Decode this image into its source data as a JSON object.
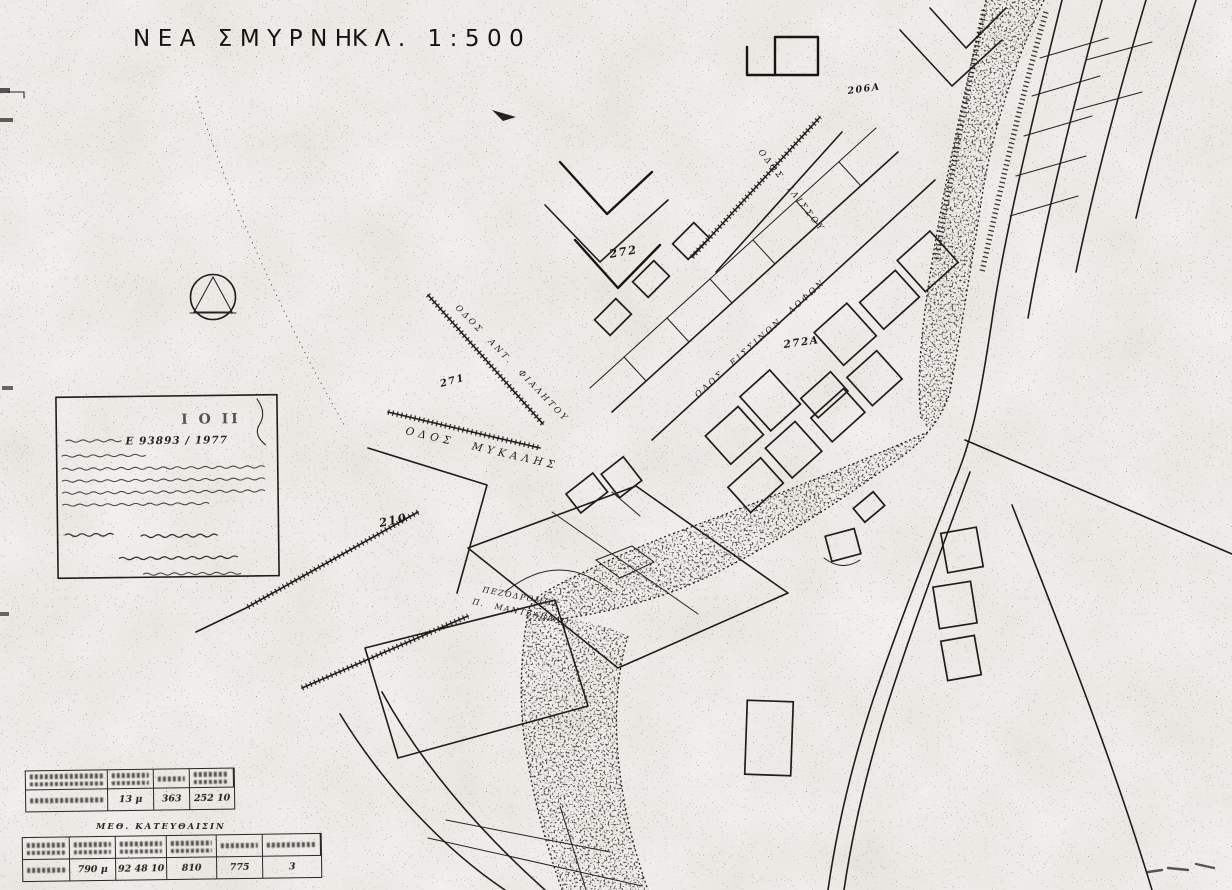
{
  "meta": {
    "paper_color": "#f3f2ee",
    "ink_color": "#1e1d1a"
  },
  "title": {
    "name": "ΝΕΑ ΣΜΥΡΝΗ",
    "scale": "ΚΛ. 1:500"
  },
  "streets": {
    "mykalis": "ΟΔΟΣ ΜΥΚΑΛΗΣ",
    "fialitou": "ΟΔΟΣ ΑΝΤ. ΦΙΑΛΗΤΟΥ",
    "lofon": "ΟΔΟΣ ΕΙΣΣΙΝΩΝ ΛΟΦΩΝ",
    "ilissou": "ΟΔΟΣ ΙΛΙΣΣΟΥ",
    "pezodromos_line1": "ΠΕΖΟΔΡΟΜΟΣ",
    "pezodromos_line2": "Π. ΜΑΝΤΖΑΒΑΛΟ"
  },
  "blocks": {
    "b206a": "206Α",
    "b272": "272",
    "b272a": "272Α",
    "b271": "271",
    "b210": "210"
  },
  "stamp": {
    "header_fragment": "Ι Ο ΙΙ",
    "protocol_number": "Ε 93893 / 1977"
  },
  "tables": {
    "measurements": {
      "row": [
        "13 μ",
        "363",
        "252 10"
      ]
    },
    "directions": {
      "title": "ΜΕΘ. ΚΑΤΕΥΘΑΙΣΙΝ",
      "row": [
        "790 μ",
        "92 48 10",
        "810",
        "775",
        "3"
      ]
    }
  }
}
